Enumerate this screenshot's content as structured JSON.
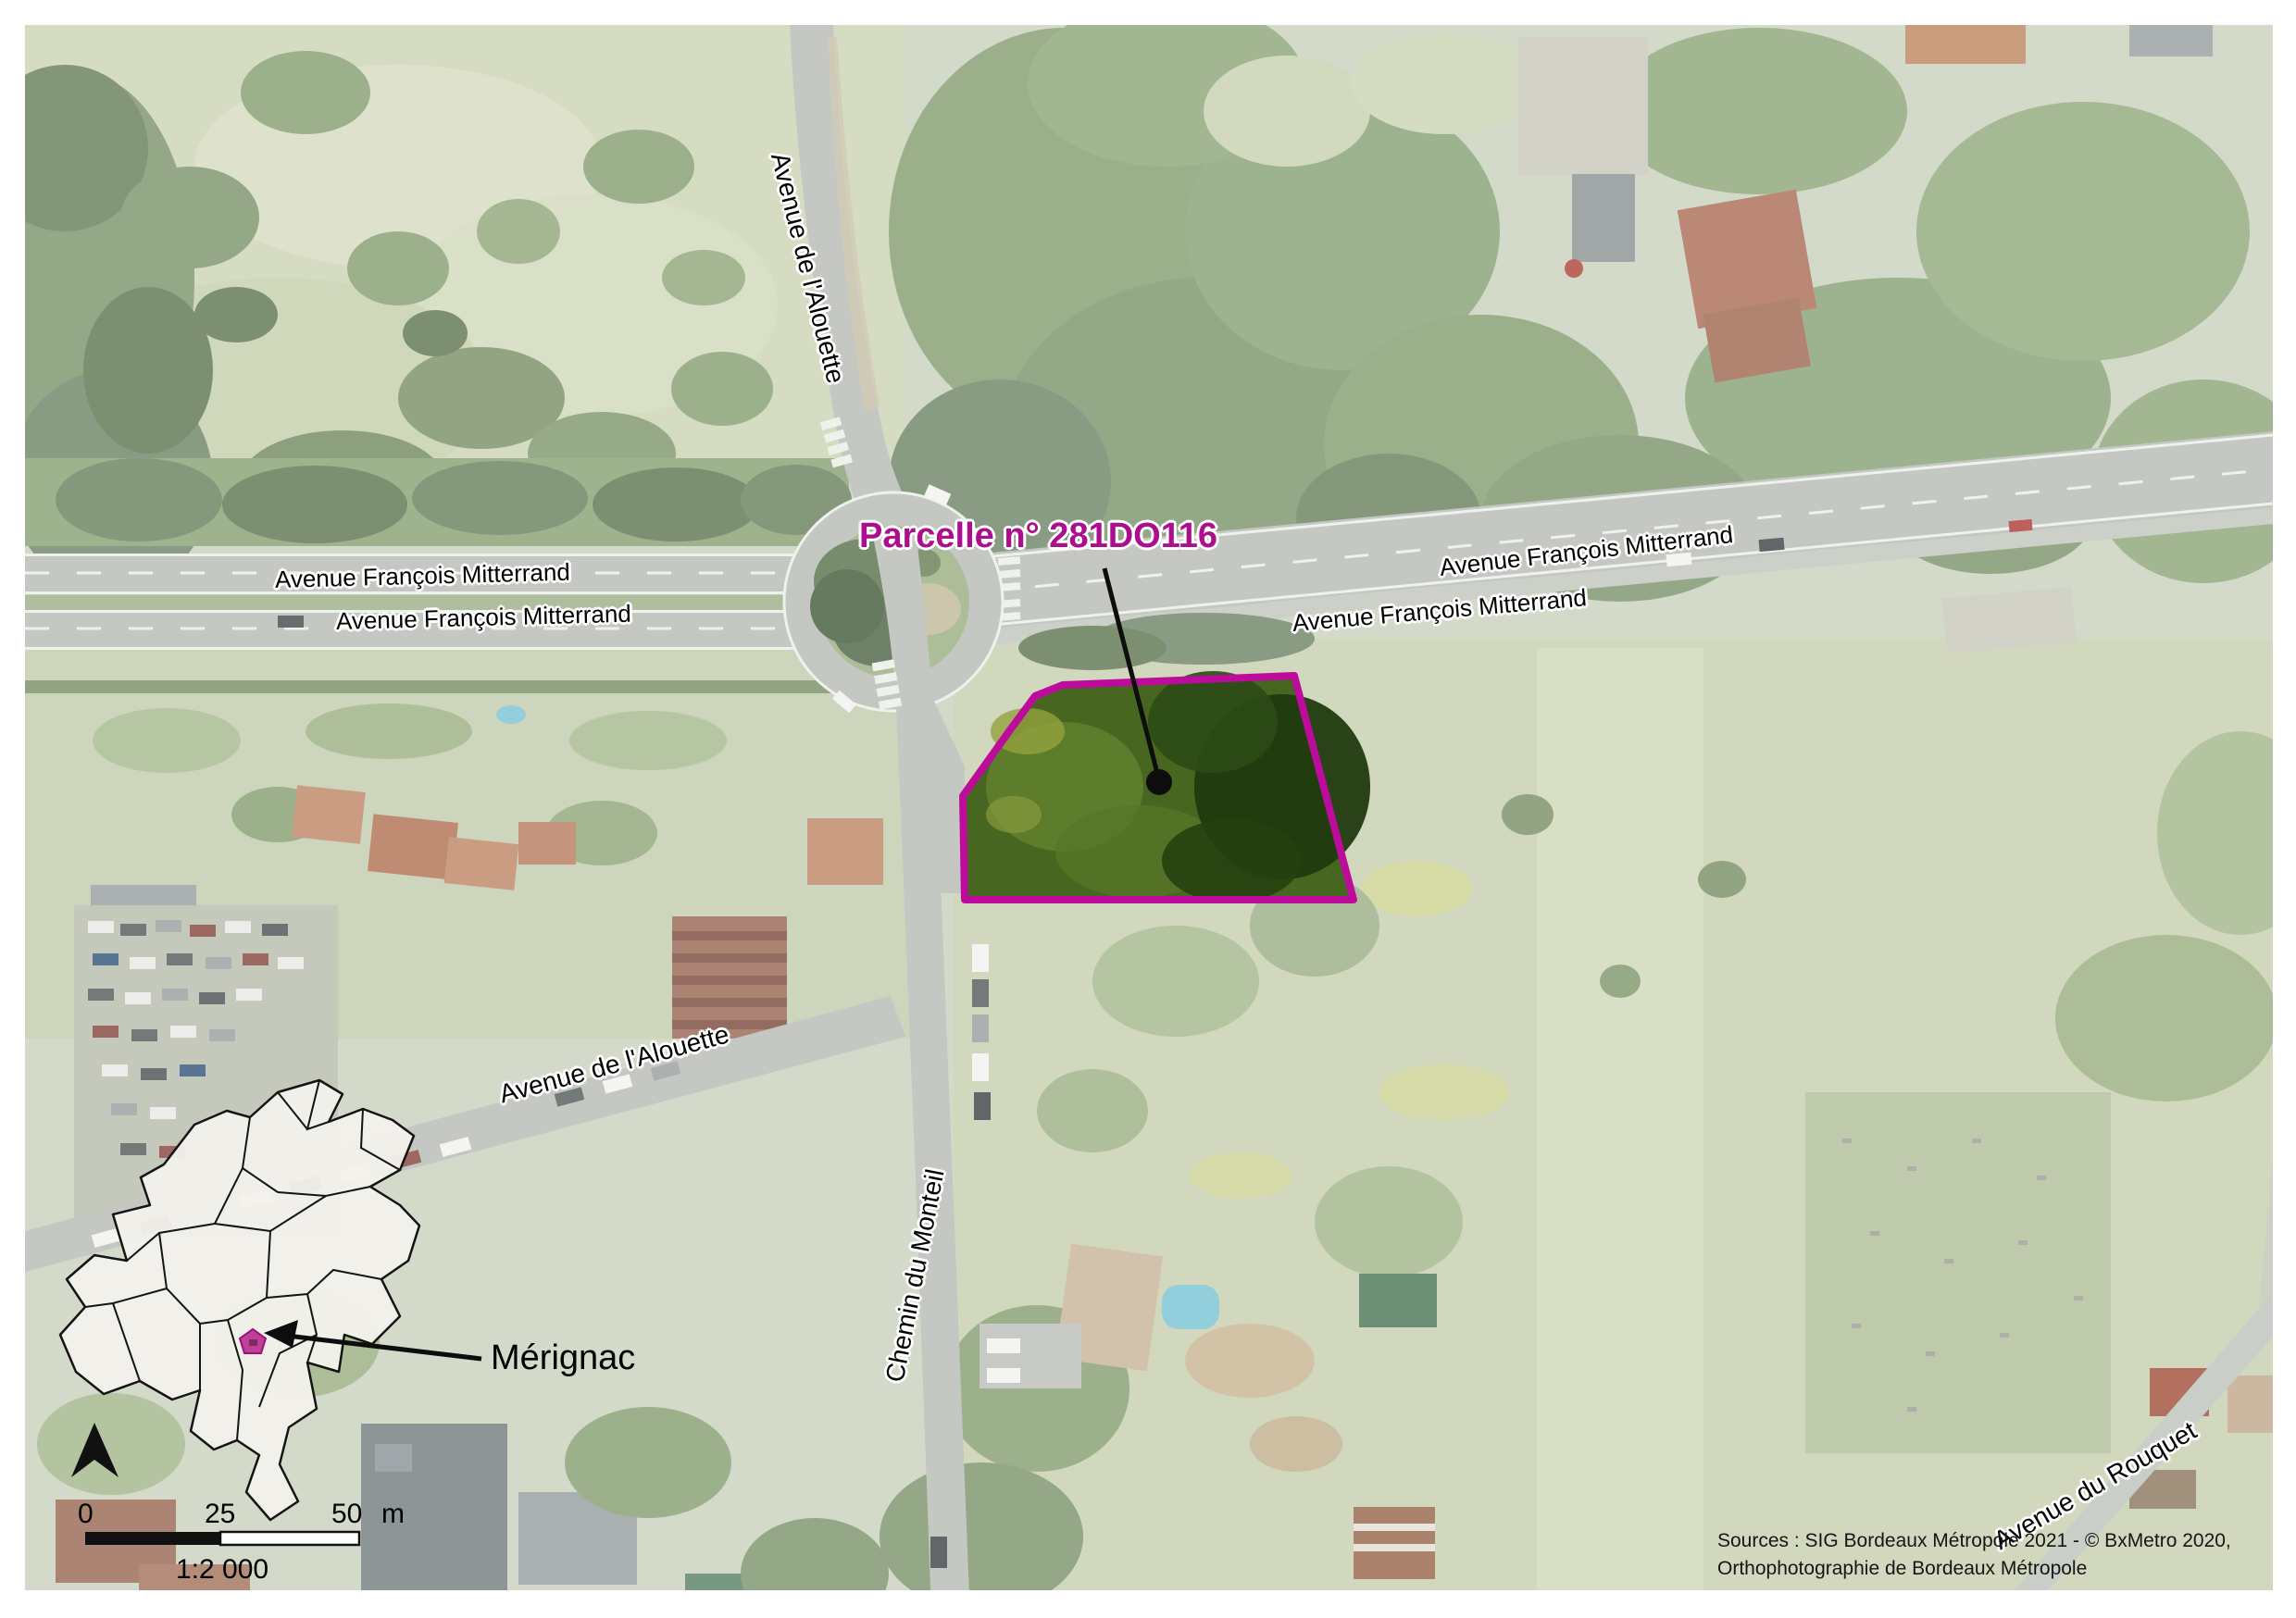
{
  "map": {
    "parcel": {
      "label": "Parcelle n° 281DO116"
    },
    "streets": {
      "alouette_north": "Avenue de l'Alouette",
      "mitterrand_left_1": "Avenue François Mitterrand",
      "mitterrand_left_2": "Avenue François Mitterrand",
      "mitterrand_right_1": "Avenue François Mitterrand",
      "mitterrand_right_2": "Avenue François Mitterrand",
      "alouette_southwest": "Avenue de l'Alouette",
      "monteil": "Chemin du Monteil",
      "rouquet": "Avenue du Rouquet"
    },
    "inset": {
      "commune_label": "Mérignac"
    },
    "scale_bar": {
      "tick_0": "0",
      "tick_25": "25",
      "tick_50": "50",
      "unit": "m",
      "ratio": "1:2 000"
    },
    "sources": {
      "line1": "Sources : SIG Bordeaux Métropole 2021 - © BxMetro 2020,",
      "line2": "Orthophotographie de Bordeaux Métropole"
    },
    "colors": {
      "parcel_outline": "#bd0c9b",
      "parcel_label": "#ad0e8d",
      "marker": "#bf3f9b"
    }
  }
}
